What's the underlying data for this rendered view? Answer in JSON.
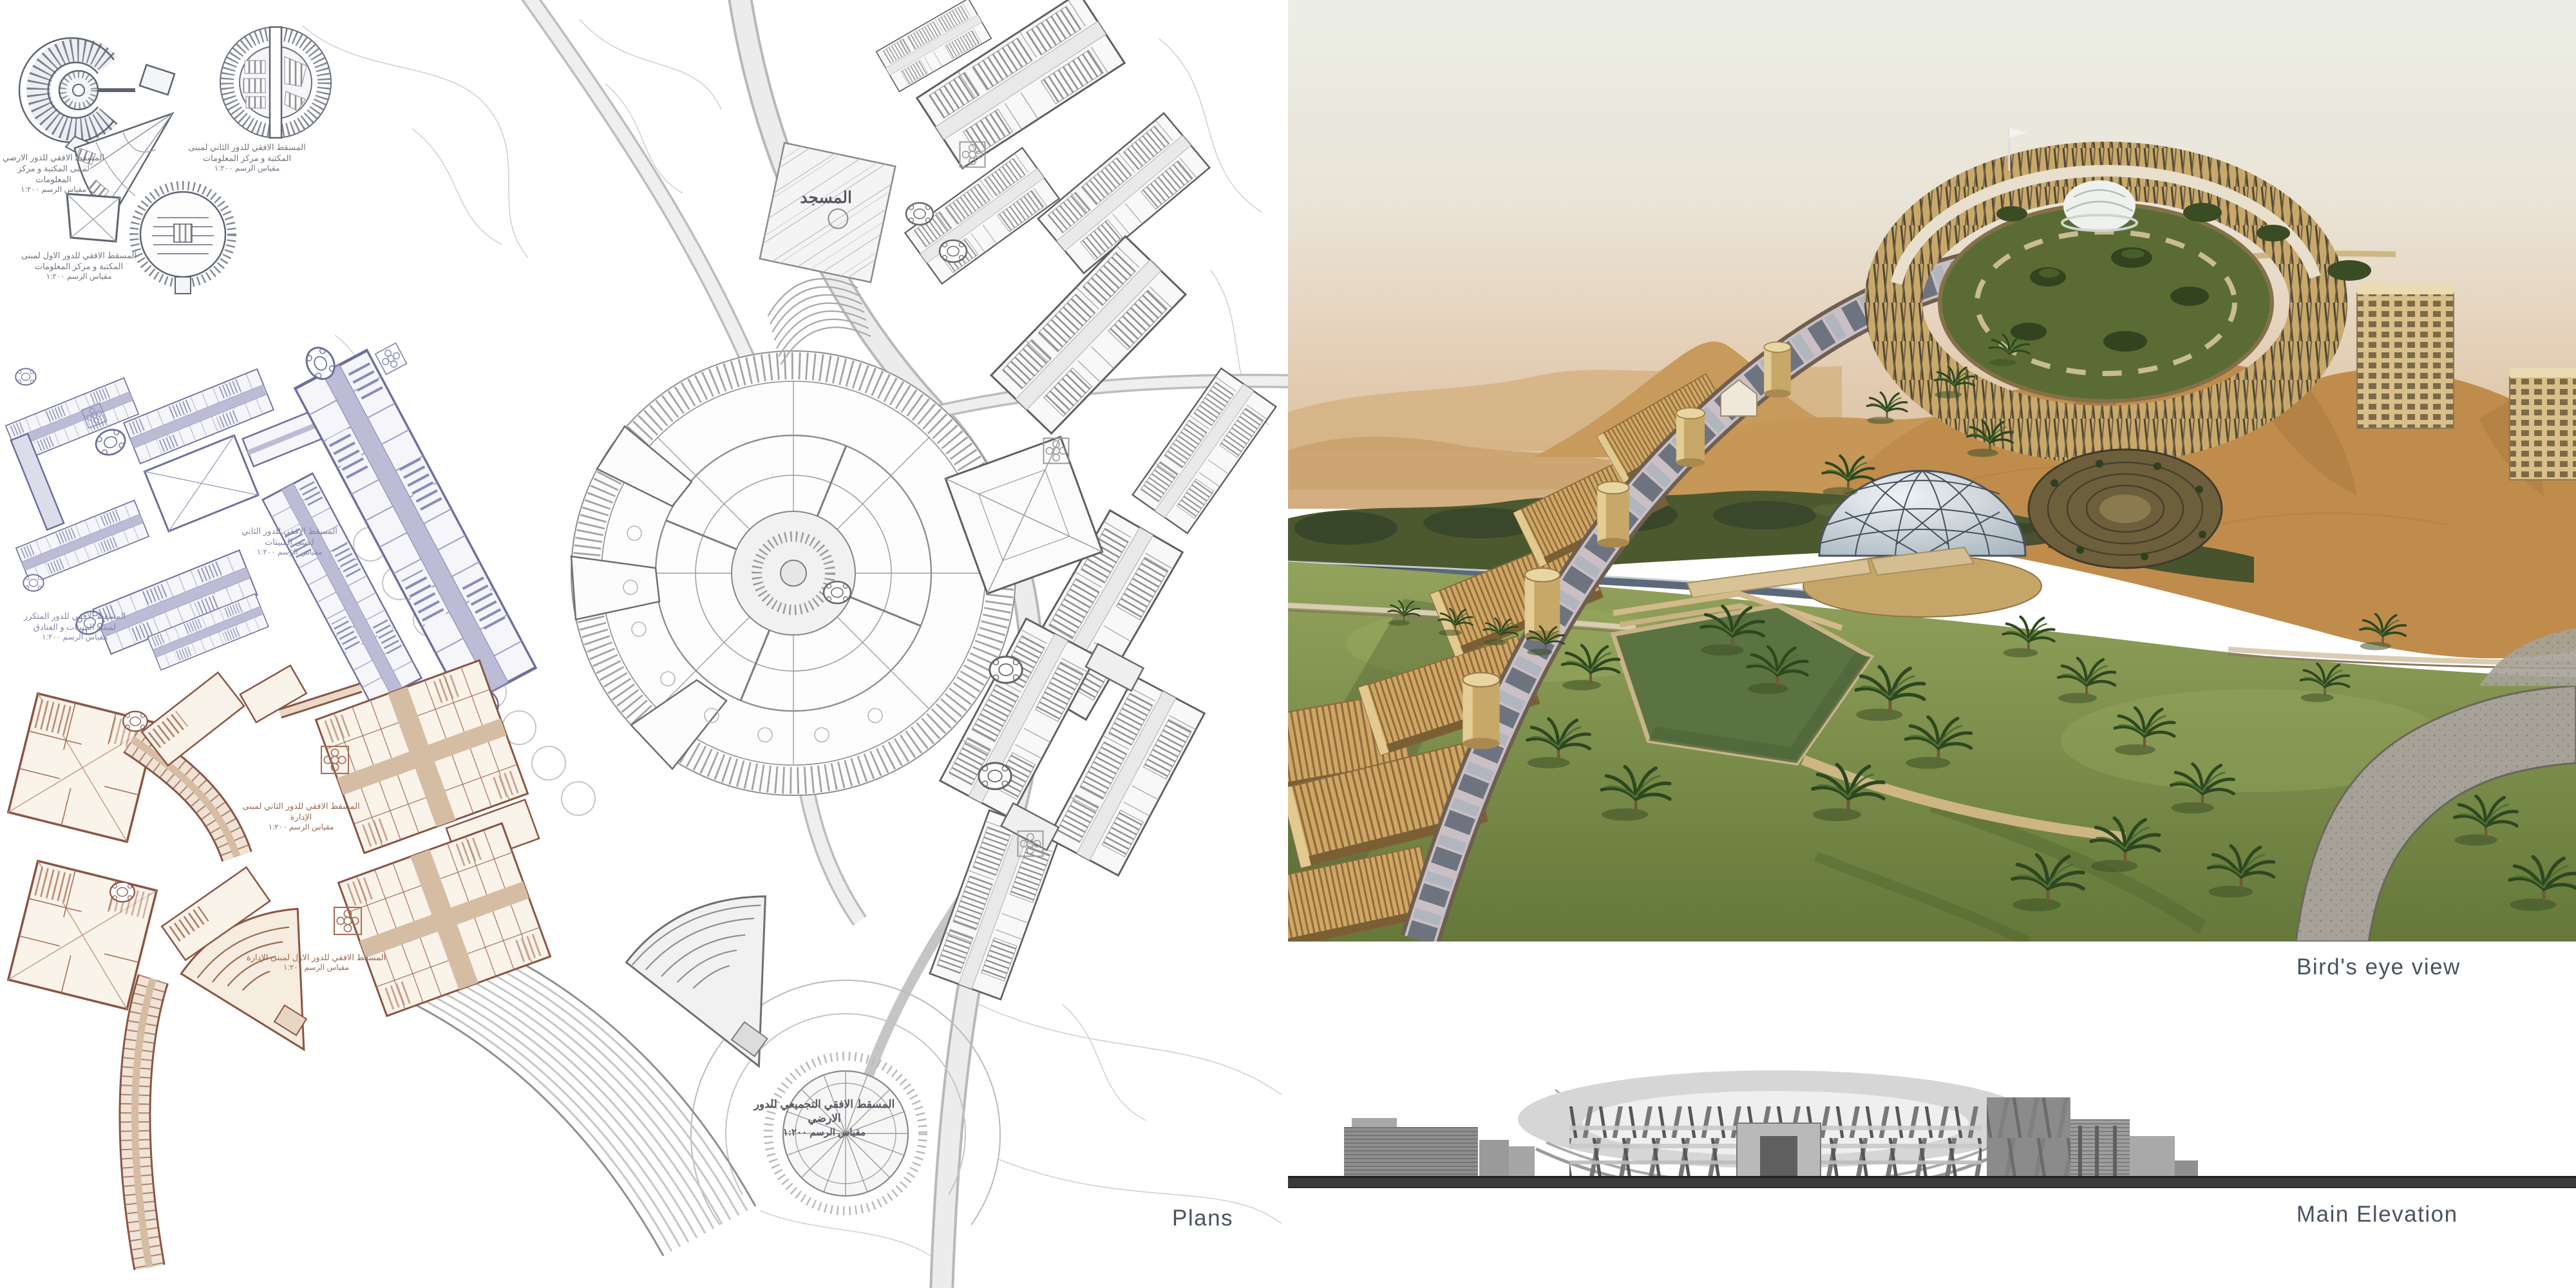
{
  "labels": {
    "plans": "Plans",
    "birds_eye_view": "Bird's eye view",
    "main_elevation": "Main Elevation"
  },
  "site_plan": {
    "mosque_label": "المسجد"
  },
  "captions": {
    "library_ground": {
      "line1": "المسقط الافقي للدور الارضي لمبنى المكتبة و مركز المعلومات",
      "line2": "مقياس الرسم ١:٢٠٠"
    },
    "library_second": {
      "line1": "المسقط الافقي للدور الثاني لمبنى المكتبة و مركز المعلومات",
      "line2": "مقياس الرسم ١:٢٠٠"
    },
    "library_first": {
      "line1": "المسقط الافقي للدور الاول لمبنى المكتبة و مركز المعلومات",
      "line2": "مقياس الرسم ١:٢٠٠"
    },
    "hostel_typical": {
      "line1": "المسقط الافقي للدور المتكرر لمبنى المبيتات و الفنادق",
      "line2": "مقياس الرسم ١:٢٠٠"
    },
    "hostel_second": {
      "line1": "المسقط الافقي للدور الثاني لمبنى المبيتات",
      "line2": "مقياس الرسم ١:٢٠٠"
    },
    "admin_second": {
      "line1": "المسقط الافقي للدور الثاني لمبنى الإدارة",
      "line2": "مقياس الرسم ١:٢٠٠"
    },
    "admin_first": {
      "line1": "المسقط الافقي للدور الاول لمبنى الإدارة",
      "line2": "مقياس الرسم ١:٢٠٠"
    },
    "master_ground": {
      "line1": "المسقط الافقي التجميعي للدور الارضي",
      "line2": "مقياس الرسم ١:٢٠٠"
    }
  },
  "colors": {
    "label_text": "#4A535F",
    "site_line": "#9A9A9A",
    "library_plan_line": "#5F6470",
    "hostel_plan_line": "#6F6F9E",
    "hostel_plan_fill": "#BCBCD6",
    "admin_plan_line": "#8A5544",
    "admin_plan_fill": "#D9C4AE",
    "ground_bar": "#3A3A3C",
    "sky": "#E8E9E1",
    "dune": "#C08C4C",
    "tree_band": "#4C592F",
    "lawn": "#6F833F",
    "building_tan": "#D7B97E",
    "dome_glass": "#C8D4DC"
  }
}
